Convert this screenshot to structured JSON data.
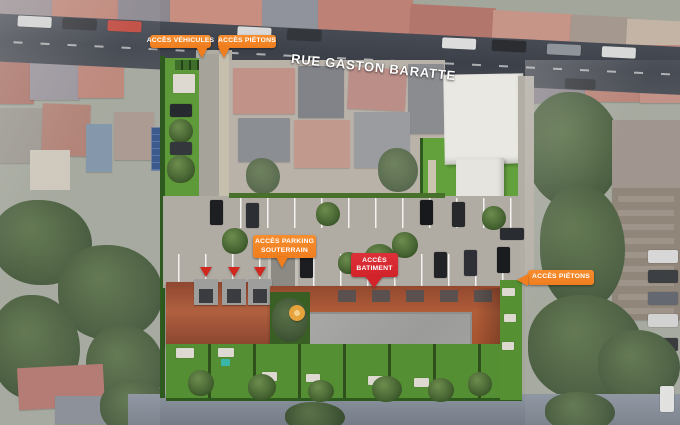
{
  "street": {
    "name": "RUE GASTON BARATTE"
  },
  "labels": {
    "vehicles": {
      "text": "ACCÈS VÉHICULES"
    },
    "pedestrians_top": {
      "text": "ACCÈS PIÉTONS"
    },
    "parking": {
      "line1": "ACCÈS PARKING",
      "line2": "SOUTERRAIN"
    },
    "building": {
      "line1": "ACCÈS",
      "line2": "BATIMENT"
    },
    "pedestrians_east": {
      "text": "ACCÈS PIÉTONS"
    }
  },
  "colors": {
    "label_orange": "#F07E1F",
    "label_red": "#D2232A",
    "label_text": "#FFFFFF"
  }
}
